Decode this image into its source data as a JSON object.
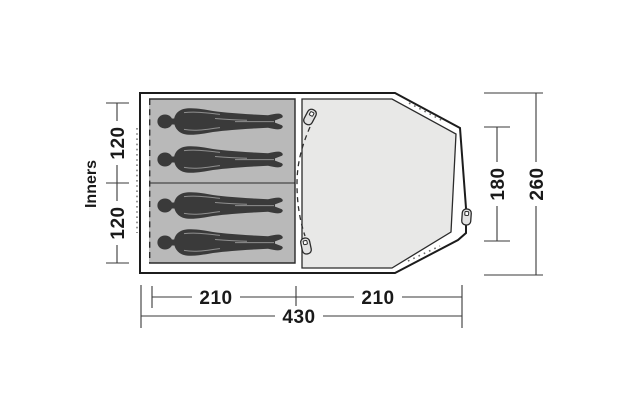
{
  "diagram": {
    "type": "tent-floorplan-top-view",
    "inners_label": "Inners",
    "capacity_persons": 4,
    "dimensions": {
      "inner_top_width": "120",
      "inner_bottom_width": "120",
      "living_inner_depth": "180",
      "total_depth": "260",
      "inner_length": "210",
      "living_length": "210",
      "total_length": "430"
    },
    "colors": {
      "inner_area_fill": "#b9b9b9",
      "living_area_fill": "#e8e8e7",
      "silhouette": "#3a3a3a",
      "outline": "#1c1c1c",
      "dimension_line": "#3a3a3a"
    }
  }
}
